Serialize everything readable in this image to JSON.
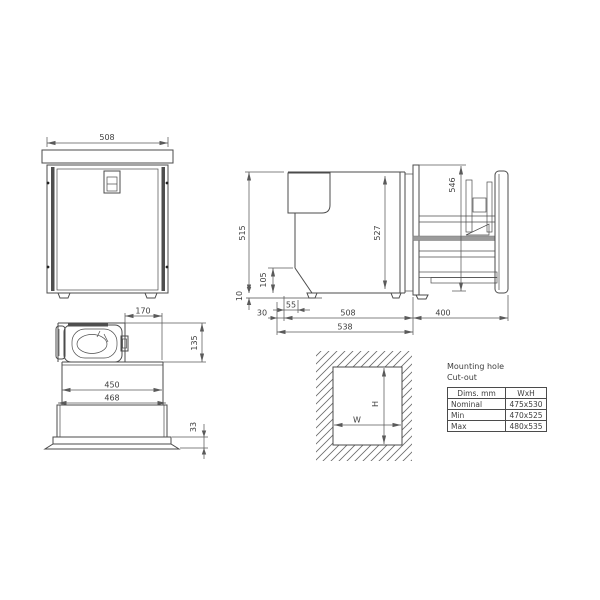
{
  "views": {
    "front": {
      "width": "508"
    },
    "side": {
      "height": "515",
      "interior_height": "527",
      "panel_height": "546",
      "bottom_inset_height": "105",
      "foot_height": "10",
      "front_offset": "30",
      "foot_offset": "55",
      "body_depth": "508",
      "drawer_extension": "400",
      "overall_depth": "538"
    },
    "top": {
      "compressor_offset": "170",
      "compressor_depth": "135",
      "inner_width": "450",
      "outer_width": "468",
      "flange_height": "33"
    },
    "cutout": {
      "width_label": "W",
      "height_label": "H"
    }
  },
  "table": {
    "title_line1": "Mounting hole",
    "title_line2": "Cut-out",
    "headers": [
      "Dims. mm",
      "WxH"
    ],
    "rows": [
      {
        "label": "Nominal",
        "value": "475x530"
      },
      {
        "label": "Min",
        "value": "470x525"
      },
      {
        "label": "Max",
        "value": "480x535"
      }
    ]
  }
}
